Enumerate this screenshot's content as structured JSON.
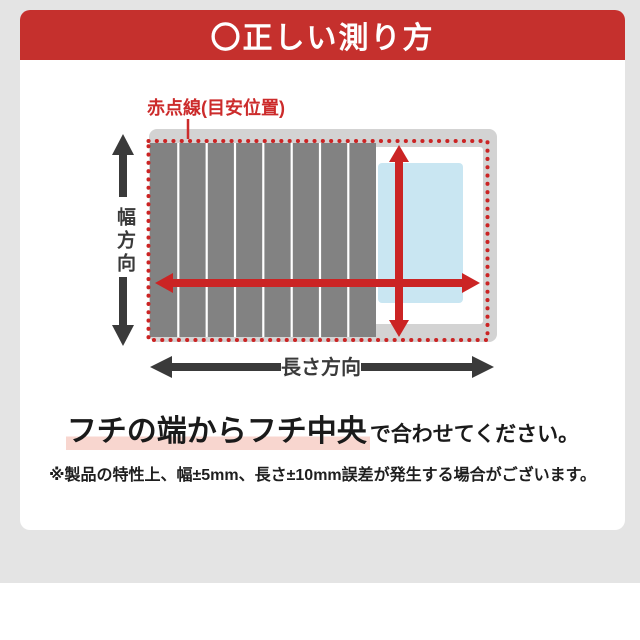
{
  "header": {
    "title": "〇正しい測り方",
    "bg_color": "#c5302d",
    "text_color": "#ffffff"
  },
  "diagram": {
    "annotation_label": "赤点線(目安位置)",
    "width_axis_label": "幅方向",
    "length_axis_label": "長さ方向",
    "colors": {
      "accent_red": "#cb2424",
      "label_red": "#cc2b2b",
      "lid_gray": "#828282",
      "rim_gray": "#d3d3d3",
      "tub_white": "#ffffff",
      "water_blue": "#c9e6f2",
      "arrow_dark": "#3a3a3a"
    }
  },
  "instruction": {
    "highlight_text": "フチの端からフチ中央",
    "suffix_text": "で合わせてください。",
    "highlight_color": "#f8d6cf"
  },
  "footnote": {
    "text": "※製品の特性上、幅±5mm、長さ±10mm誤差が発生する場合がございます。"
  }
}
